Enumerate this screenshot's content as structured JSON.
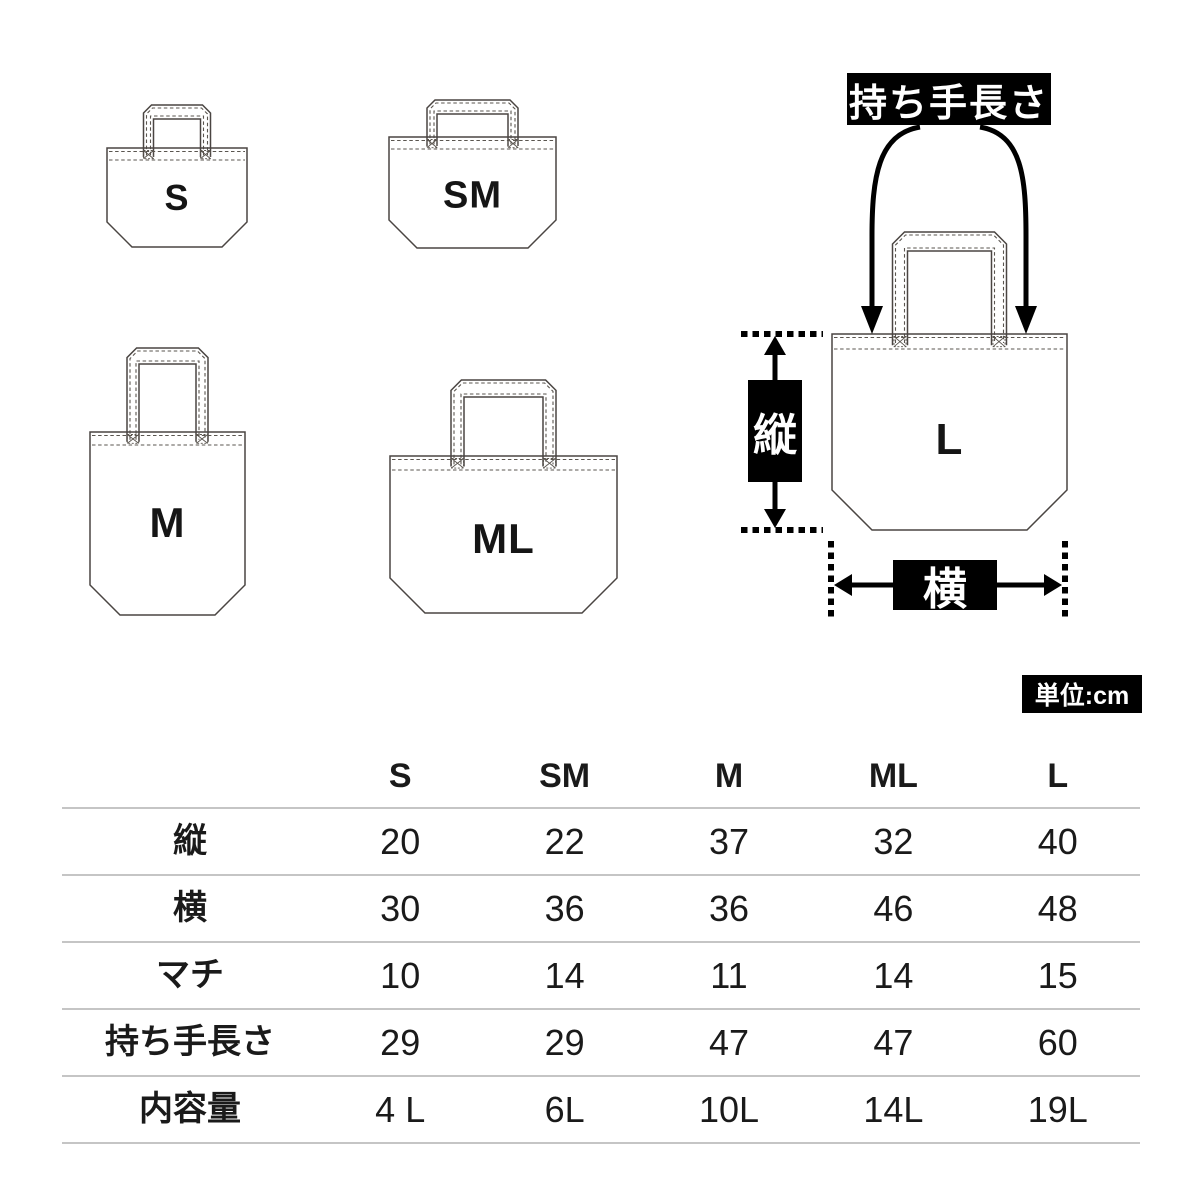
{
  "diagram": {
    "bags": [
      {
        "id": "s",
        "label": "S"
      },
      {
        "id": "sm",
        "label": "SM"
      },
      {
        "id": "m",
        "label": "M"
      },
      {
        "id": "ml",
        "label": "ML"
      },
      {
        "id": "l",
        "label": "L"
      }
    ],
    "annotations": {
      "handle_length_label": "持ち手長さ",
      "height_label": "縦",
      "width_label": "横",
      "unit_label": "単位:cm"
    }
  },
  "size_table": {
    "columns": [
      "S",
      "SM",
      "M",
      "ML",
      "L"
    ],
    "rows": [
      {
        "label": "縦",
        "values": [
          "20",
          "22",
          "37",
          "32",
          "40"
        ]
      },
      {
        "label": "横",
        "values": [
          "30",
          "36",
          "36",
          "46",
          "48"
        ]
      },
      {
        "label": "マチ",
        "values": [
          "10",
          "14",
          "11",
          "14",
          "15"
        ]
      },
      {
        "label": "持ち手長さ",
        "values": [
          "29",
          "29",
          "47",
          "47",
          "60"
        ]
      },
      {
        "label": "内容量",
        "values": [
          "4 L",
          "6L",
          "10L",
          "14L",
          "19L"
        ]
      }
    ]
  },
  "chart_data": {
    "type": "table",
    "unit": "cm",
    "columns": [
      "S",
      "SM",
      "M",
      "ML",
      "L"
    ],
    "rows": [
      {
        "label": "縦",
        "values": [
          "20",
          "22",
          "37",
          "32",
          "40"
        ]
      },
      {
        "label": "横",
        "values": [
          "30",
          "36",
          "36",
          "46",
          "48"
        ]
      },
      {
        "label": "マチ",
        "values": [
          "10",
          "14",
          "11",
          "14",
          "15"
        ]
      },
      {
        "label": "持ち手長さ",
        "values": [
          "29",
          "29",
          "47",
          "47",
          "60"
        ]
      },
      {
        "label": "内容量",
        "values": [
          "4 L",
          "6L",
          "10L",
          "14L",
          "19L"
        ]
      }
    ]
  }
}
